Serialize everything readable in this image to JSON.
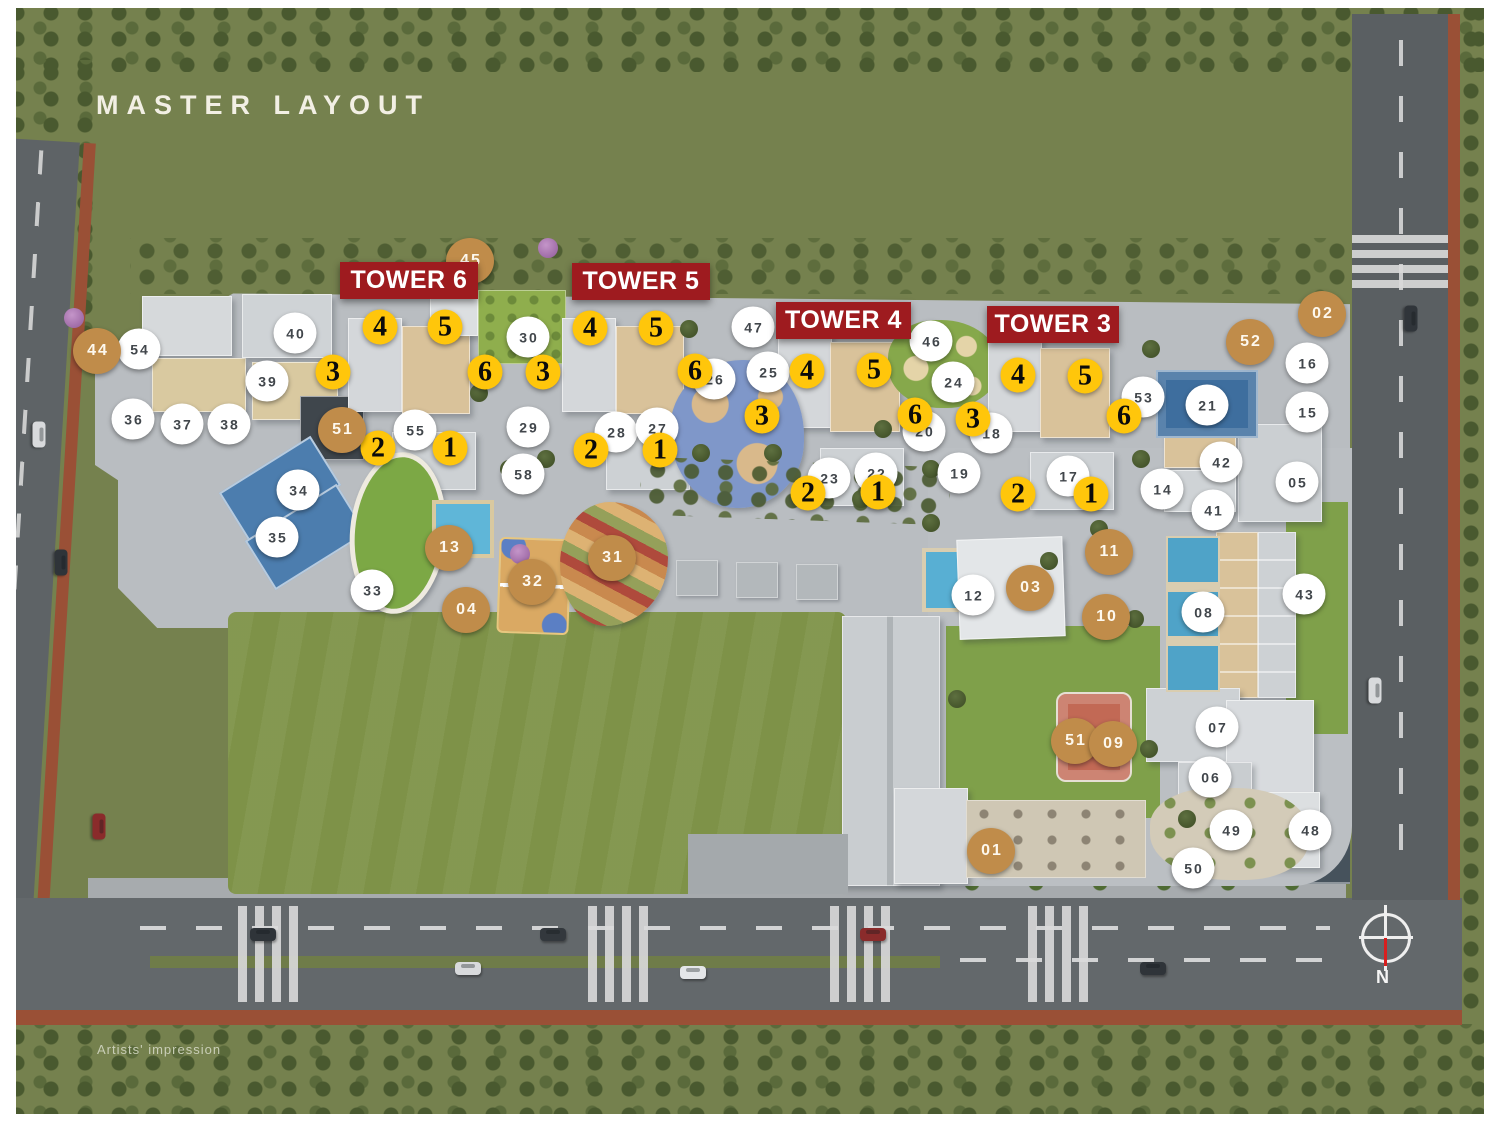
{
  "title": "MASTER LAYOUT",
  "footer_note": "Artists' impression",
  "compass": {
    "label": "N"
  },
  "colors": {
    "banner_red": "#9E1B1F",
    "marker_yellow": "#FFC60B",
    "marker_orange": "#C08C4A",
    "marker_white": "#FFFFFF",
    "field_green": "#75814E"
  },
  "towers": [
    {
      "label": "TOWER 6",
      "x": 340,
      "y": 262,
      "w": 138,
      "h": 37
    },
    {
      "label": "TOWER 5",
      "x": 572,
      "y": 263,
      "w": 138,
      "h": 37
    },
    {
      "label": "TOWER 4",
      "x": 776,
      "y": 302,
      "w": 135,
      "h": 37
    },
    {
      "label": "TOWER 3",
      "x": 987,
      "y": 306,
      "w": 132,
      "h": 37
    }
  ],
  "markers": [
    {
      "type": "white",
      "label": "54",
      "x": 139,
      "y": 349
    },
    {
      "type": "white",
      "label": "40",
      "x": 295,
      "y": 333
    },
    {
      "type": "white",
      "label": "39",
      "x": 267,
      "y": 381
    },
    {
      "type": "white",
      "label": "36",
      "x": 133,
      "y": 419
    },
    {
      "type": "white",
      "label": "37",
      "x": 182,
      "y": 424
    },
    {
      "type": "white",
      "label": "38",
      "x": 229,
      "y": 424
    },
    {
      "type": "white",
      "label": "34",
      "x": 298,
      "y": 490
    },
    {
      "type": "white",
      "label": "35",
      "x": 277,
      "y": 537
    },
    {
      "type": "white",
      "label": "33",
      "x": 372,
      "y": 590
    },
    {
      "type": "white",
      "label": "55",
      "x": 415,
      "y": 430
    },
    {
      "type": "white",
      "label": "30",
      "x": 528,
      "y": 337
    },
    {
      "type": "white",
      "label": "29",
      "x": 528,
      "y": 427
    },
    {
      "type": "white",
      "label": "58",
      "x": 523,
      "y": 474
    },
    {
      "type": "white",
      "label": "28",
      "x": 616,
      "y": 432
    },
    {
      "type": "white",
      "label": "27",
      "x": 657,
      "y": 428
    },
    {
      "type": "white",
      "label": "26",
      "x": 714,
      "y": 379
    },
    {
      "type": "white",
      "label": "25",
      "x": 768,
      "y": 372
    },
    {
      "type": "white",
      "label": "47",
      "x": 753,
      "y": 327
    },
    {
      "type": "white",
      "label": "46",
      "x": 931,
      "y": 341
    },
    {
      "type": "white",
      "label": "24",
      "x": 953,
      "y": 382
    },
    {
      "type": "white",
      "label": "20",
      "x": 924,
      "y": 431
    },
    {
      "type": "white",
      "label": "18",
      "x": 991,
      "y": 433
    },
    {
      "type": "white",
      "label": "23",
      "x": 829,
      "y": 478
    },
    {
      "type": "white",
      "label": "22",
      "x": 876,
      "y": 473
    },
    {
      "type": "white",
      "label": "19",
      "x": 959,
      "y": 473
    },
    {
      "type": "white",
      "label": "17",
      "x": 1068,
      "y": 476
    },
    {
      "type": "white",
      "label": "53",
      "x": 1143,
      "y": 397
    },
    {
      "type": "white",
      "label": "21",
      "x": 1207,
      "y": 405
    },
    {
      "type": "white",
      "label": "16",
      "x": 1307,
      "y": 363
    },
    {
      "type": "white",
      "label": "15",
      "x": 1307,
      "y": 412
    },
    {
      "type": "white",
      "label": "42",
      "x": 1221,
      "y": 462
    },
    {
      "type": "white",
      "label": "14",
      "x": 1162,
      "y": 489
    },
    {
      "type": "white",
      "label": "41",
      "x": 1213,
      "y": 510
    },
    {
      "type": "white",
      "label": "05",
      "x": 1297,
      "y": 482
    },
    {
      "type": "white",
      "label": "43",
      "x": 1304,
      "y": 594
    },
    {
      "type": "white",
      "label": "08",
      "x": 1203,
      "y": 612
    },
    {
      "type": "white",
      "label": "12",
      "x": 973,
      "y": 595
    },
    {
      "type": "white",
      "label": "07",
      "x": 1217,
      "y": 727
    },
    {
      "type": "white",
      "label": "06",
      "x": 1210,
      "y": 777
    },
    {
      "type": "white",
      "label": "49",
      "x": 1231,
      "y": 830
    },
    {
      "type": "white",
      "label": "48",
      "x": 1310,
      "y": 830
    },
    {
      "type": "white",
      "label": "50",
      "x": 1193,
      "y": 868
    },
    {
      "type": "yellow",
      "tower": "6",
      "label": "4",
      "x": 380,
      "y": 327
    },
    {
      "type": "yellow",
      "tower": "6",
      "label": "5",
      "x": 445,
      "y": 327
    },
    {
      "type": "yellow",
      "tower": "6",
      "label": "3",
      "x": 333,
      "y": 372
    },
    {
      "type": "yellow",
      "tower": "6",
      "label": "6",
      "x": 485,
      "y": 372
    },
    {
      "type": "yellow",
      "tower": "6",
      "label": "2",
      "x": 378,
      "y": 448
    },
    {
      "type": "yellow",
      "tower": "6",
      "label": "1",
      "x": 450,
      "y": 448
    },
    {
      "type": "yellow",
      "tower": "5",
      "label": "4",
      "x": 590,
      "y": 328
    },
    {
      "type": "yellow",
      "tower": "5",
      "label": "5",
      "x": 656,
      "y": 328
    },
    {
      "type": "yellow",
      "tower": "5",
      "label": "3",
      "x": 543,
      "y": 372
    },
    {
      "type": "yellow",
      "tower": "5",
      "label": "6",
      "x": 695,
      "y": 371
    },
    {
      "type": "yellow",
      "tower": "5",
      "label": "2",
      "x": 591,
      "y": 450
    },
    {
      "type": "yellow",
      "tower": "5",
      "label": "1",
      "x": 660,
      "y": 450
    },
    {
      "type": "yellow",
      "tower": "4",
      "label": "4",
      "x": 807,
      "y": 371
    },
    {
      "type": "yellow",
      "tower": "4",
      "label": "5",
      "x": 874,
      "y": 370
    },
    {
      "type": "yellow",
      "tower": "4",
      "label": "3",
      "x": 762,
      "y": 416
    },
    {
      "type": "yellow",
      "tower": "4",
      "label": "6",
      "x": 915,
      "y": 415
    },
    {
      "type": "yellow",
      "tower": "4",
      "label": "2",
      "x": 808,
      "y": 493
    },
    {
      "type": "yellow",
      "tower": "4",
      "label": "1",
      "x": 878,
      "y": 492
    },
    {
      "type": "yellow",
      "tower": "3",
      "label": "4",
      "x": 1018,
      "y": 375
    },
    {
      "type": "yellow",
      "tower": "3",
      "label": "5",
      "x": 1085,
      "y": 376
    },
    {
      "type": "yellow",
      "tower": "3",
      "label": "3",
      "x": 973,
      "y": 419
    },
    {
      "type": "yellow",
      "tower": "3",
      "label": "6",
      "x": 1124,
      "y": 416
    },
    {
      "type": "yellow",
      "tower": "3",
      "label": "2",
      "x": 1018,
      "y": 494
    },
    {
      "type": "yellow",
      "tower": "3",
      "label": "1",
      "x": 1091,
      "y": 494
    },
    {
      "type": "orange",
      "label": "44",
      "x": 97,
      "y": 351
    },
    {
      "type": "orange",
      "label": "45",
      "x": 470,
      "y": 261
    },
    {
      "type": "orange",
      "label": "51",
      "x": 342,
      "y": 430
    },
    {
      "type": "orange",
      "label": "13",
      "x": 449,
      "y": 548
    },
    {
      "type": "orange",
      "label": "31",
      "x": 612,
      "y": 558
    },
    {
      "type": "orange",
      "label": "32",
      "x": 532,
      "y": 582
    },
    {
      "type": "orange",
      "label": "04",
      "x": 466,
      "y": 610
    },
    {
      "type": "orange",
      "label": "02",
      "x": 1322,
      "y": 314
    },
    {
      "type": "orange",
      "label": "52",
      "x": 1250,
      "y": 342
    },
    {
      "type": "orange",
      "label": "03",
      "x": 1030,
      "y": 588
    },
    {
      "type": "orange",
      "label": "11",
      "x": 1109,
      "y": 552
    },
    {
      "type": "orange",
      "label": "10",
      "x": 1106,
      "y": 617
    },
    {
      "type": "orange",
      "label": "51",
      "x": 1075,
      "y": 741
    },
    {
      "type": "orange",
      "label": "09",
      "x": 1113,
      "y": 744
    },
    {
      "type": "orange",
      "label": "01",
      "x": 991,
      "y": 851
    }
  ]
}
